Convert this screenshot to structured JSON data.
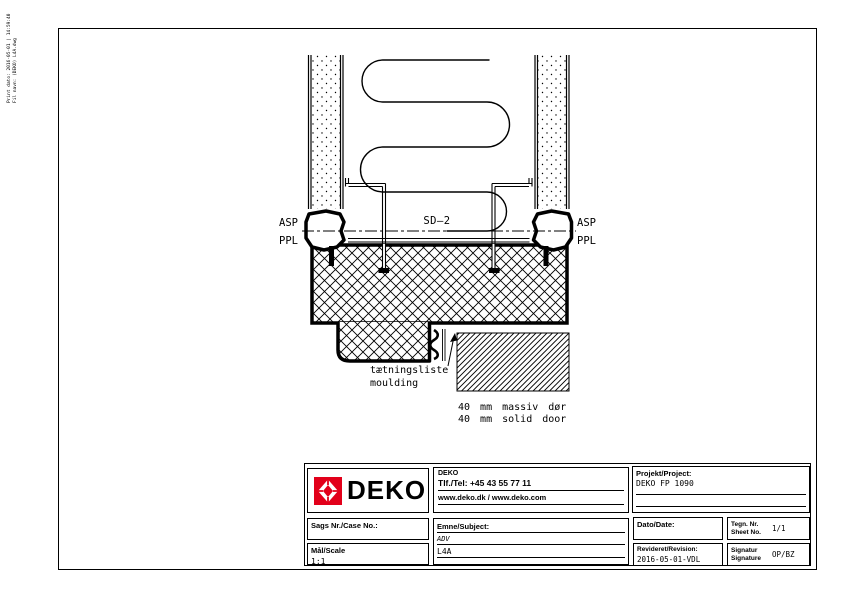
{
  "colors": {
    "brand_red": "#e2001a",
    "line": "#000000",
    "paper": "#ffffff"
  },
  "stamp": {
    "line1": "Print dato: 2016-05-01 | 14:59:40",
    "line2": "Fil navn: (DEKO) L4A.dwg"
  },
  "drawing": {
    "label_sd2": "SD–2",
    "label_asp": "ASP",
    "label_ppl": "PPL",
    "seal_label_da": "tætningsliste",
    "seal_label_en": "moulding",
    "door_label_da": "40 mm massiv dør",
    "door_label_en": "40 mm solid door"
  },
  "titleblock": {
    "logo_text": "DEKO",
    "company": {
      "name": "DEKO",
      "phone": "Tlf./Tel: +45 43 55 77 11",
      "web": "www.deko.dk / www.deko.com"
    },
    "project": {
      "label": "Projekt/Project:",
      "value": "DEKO FP 1090"
    },
    "case_no": {
      "label": "Sags Nr./Case No.:",
      "value": ""
    },
    "scale": {
      "label": "Mål/Scale",
      "value": "1:1"
    },
    "subject": {
      "label": "Emne/Subject:",
      "value_line1": "ADV",
      "value_line2": "L4A"
    },
    "date": {
      "label": "Dato/Date:",
      "value": ""
    },
    "sheet_no": {
      "label_da": "Tegn. Nr.",
      "label_en": "Sheet No.",
      "value": "1/1"
    },
    "revision": {
      "label": "Revideret/Revision:",
      "value": "2016-05-01-VDL"
    },
    "signature": {
      "label_da": "Signatur",
      "label_en": "Signature",
      "value": "OP/BZ"
    }
  }
}
